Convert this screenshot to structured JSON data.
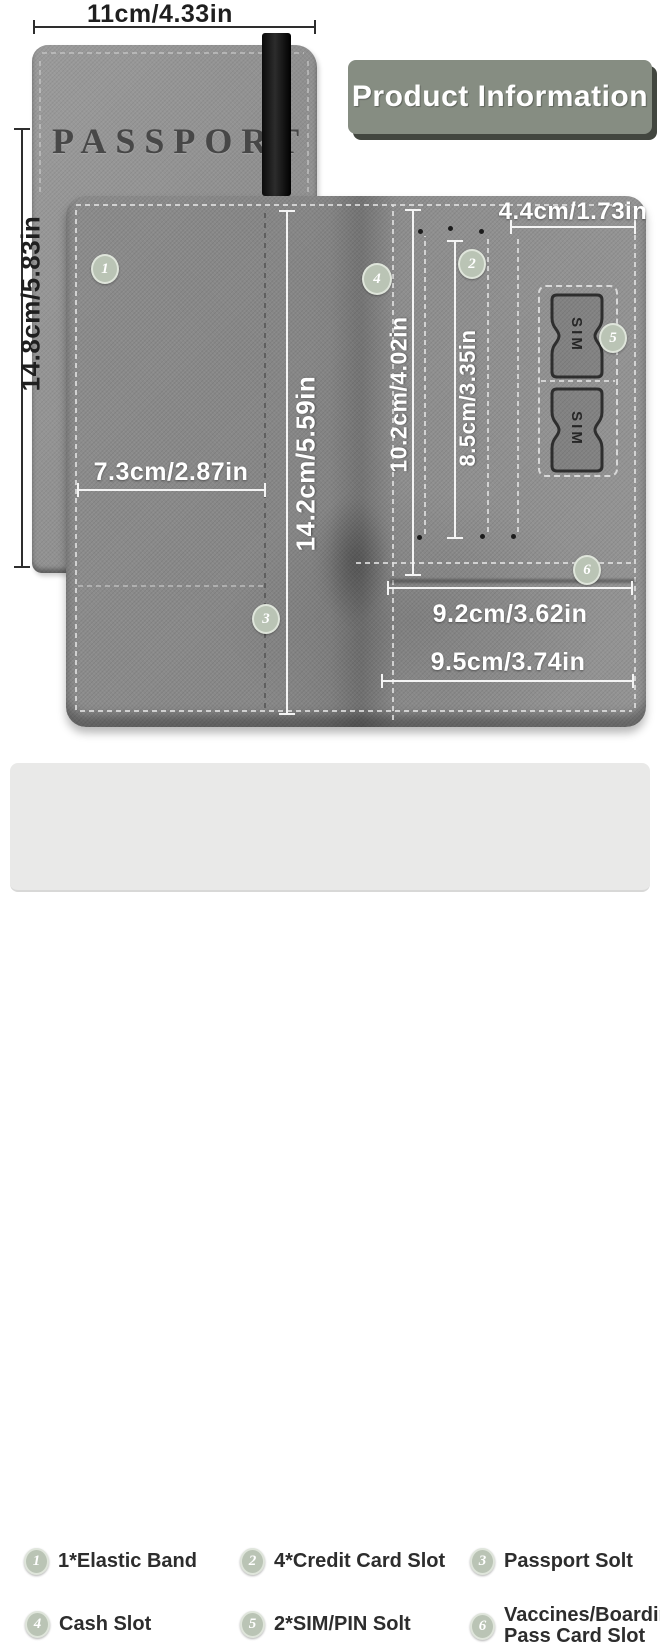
{
  "title": {
    "text": "Product Information"
  },
  "cover": {
    "brand_text": "PASSPORT",
    "width_label": "11cm/4.33in",
    "height_label": "14.8cm/5.83in"
  },
  "wallet": {
    "sim_label": "SIM",
    "markers": [
      "1",
      "2",
      "3",
      "4",
      "5",
      "6"
    ],
    "dimensions": {
      "cash_slot_width": "7.3cm/2.87in",
      "passport_slot_height": "14.2cm/5.59in",
      "card_slot_height": "10.2cm/4.02in",
      "card_slot_inner_height": "8.5cm/3.35in",
      "sim_panel_width": "4.4cm/1.73in",
      "inner_pocket_width": "9.2cm/3.62in",
      "outer_pocket_width": "9.5cm/3.74in"
    }
  },
  "legend": {
    "items": [
      {
        "num": "1",
        "label": "1*Elastic Band"
      },
      {
        "num": "2",
        "label": "4*Credit Card Slot"
      },
      {
        "num": "3",
        "label": "Passport Solt"
      },
      {
        "num": "4",
        "label": "Cash Slot"
      },
      {
        "num": "5",
        "label": "2*SIM/PIN Solt"
      },
      {
        "num": "6",
        "label": "Vaccines/Boarding Pass Card Slot"
      }
    ]
  },
  "colors": {
    "leather": "#8e8e8e",
    "badge": "#bac4b5",
    "title_bg": "#868d82",
    "legend_bg": "#e9e9e8"
  }
}
